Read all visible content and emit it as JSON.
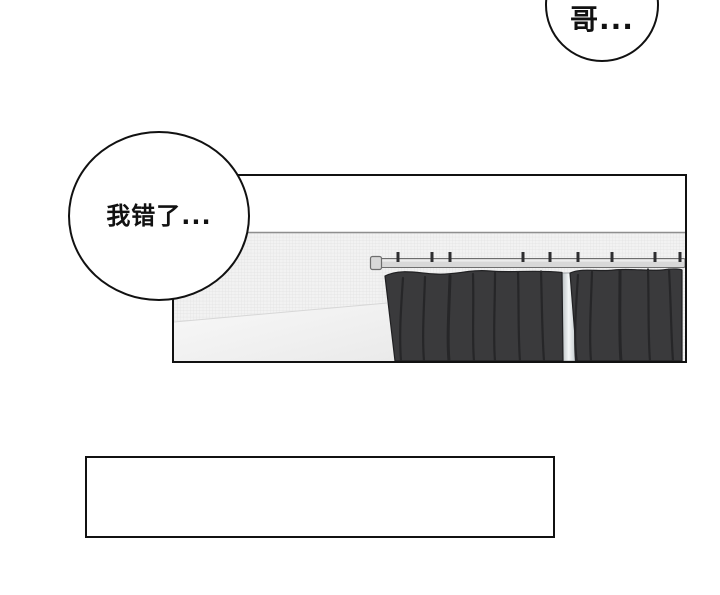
{
  "page": {
    "background": "#ffffff"
  },
  "bubbles": {
    "top": {
      "text": "哥..."
    },
    "left": {
      "text": "我错了..."
    }
  },
  "caption_box": {
    "text": ""
  },
  "colors": {
    "ink": "#111111",
    "paper": "#ffffff",
    "wall_base": "#f2f2f2",
    "wall_grid": "#e0e0e0",
    "wall_line": "#8f8f8f",
    "floor_light": "#f8f8f8",
    "floor_shade": "#eaeaea",
    "floor_edge": "#d7d7d7",
    "rail": "#d8d8d8",
    "rail_stroke": "#6e6e6e",
    "rail_highlight": "#efefef",
    "hook": "#2e2e30",
    "curtain": "#3a3a3c",
    "curtain_fold": "#262628",
    "curtain_outline": "#202022",
    "gap_edge": "#b9bfc2",
    "gap_light": "#f4f7f8",
    "gap_stroke": "#8e9396"
  }
}
